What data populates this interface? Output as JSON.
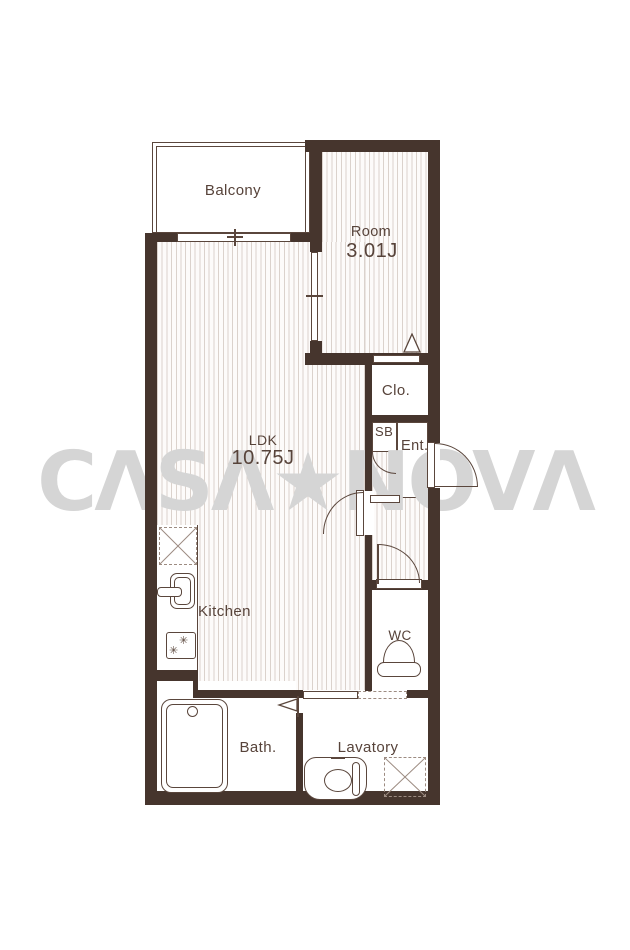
{
  "watermark": {
    "text": "CASA★NOVA",
    "display": "CΛSΛ★NOVΛ",
    "color": "#d5d5d5"
  },
  "palette": {
    "wall": "#46352d",
    "line": "#5a463c",
    "stripe": "#dbd2cc",
    "floor": "#fdfbfa",
    "text": "#57433a",
    "watermark_gray": "#d5d5d5"
  },
  "rooms": {
    "balcony": {
      "label": "Balcony"
    },
    "room": {
      "label": "Room",
      "size": "3.01J"
    },
    "ldk": {
      "label": "LDK",
      "size": "10.75J"
    },
    "closet": {
      "label": "Clo."
    },
    "shoebox": {
      "label": "SB"
    },
    "entrance": {
      "label": "Ent."
    },
    "kitchen": {
      "label": "Kitchen"
    },
    "wc": {
      "label": "WC"
    },
    "bath": {
      "label": "Bath."
    },
    "lavatory": {
      "label": "Lavatory"
    }
  },
  "icons": {
    "stove_burner": "✳"
  }
}
